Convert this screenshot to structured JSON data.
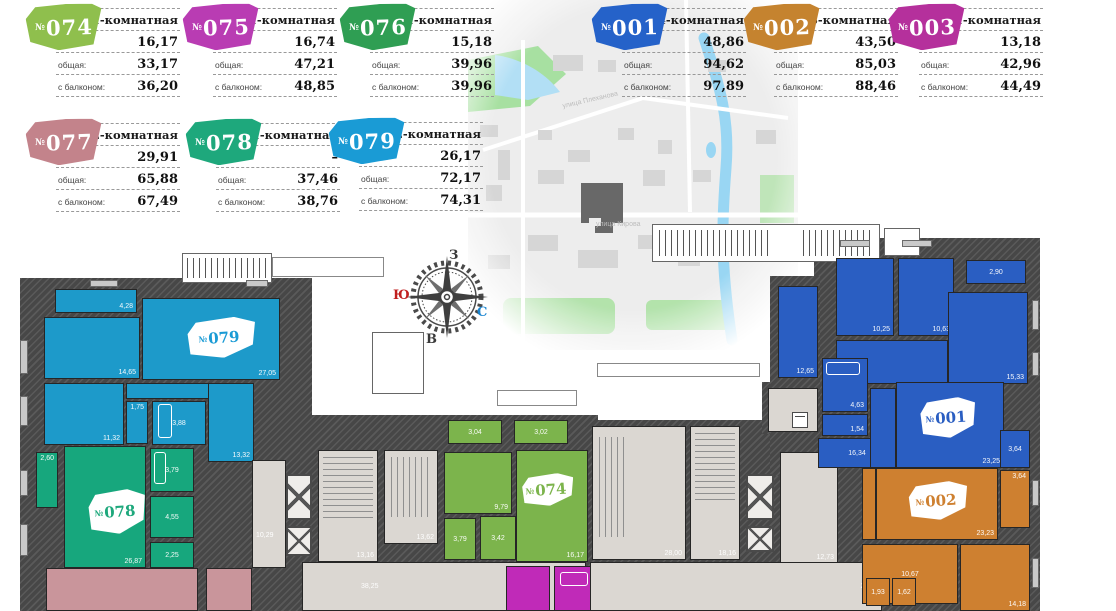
{
  "cards": [
    {
      "prefix": "№",
      "number": "074",
      "color": "#8fbf4d",
      "type": "1-комнатная",
      "rows": [
        {
          "label": "жилая:",
          "value": "16,17"
        },
        {
          "label": "общая:",
          "value": "33,17"
        },
        {
          "label": "с балконом:",
          "value": "36,20"
        }
      ]
    },
    {
      "prefix": "№",
      "number": "075",
      "color": "#b93cb3",
      "type": "1-комнатная",
      "rows": [
        {
          "label": "жилая:",
          "value": "16,74"
        },
        {
          "label": "общая:",
          "value": "47,21"
        },
        {
          "label": "с балконом:",
          "value": "48,85"
        }
      ]
    },
    {
      "prefix": "№",
      "number": "076",
      "color": "#2f9e53",
      "type": "1-комнатная",
      "rows": [
        {
          "label": "жилая:",
          "value": "15,18"
        },
        {
          "label": "общая:",
          "value": "39,96"
        },
        {
          "label": "с балконом:",
          "value": "39,96"
        }
      ]
    },
    {
      "prefix": "№",
      "number": "001",
      "color": "#2562c9",
      "type": "4-комнатная",
      "rows": [
        {
          "label": "жилая:",
          "value": "48,86"
        },
        {
          "label": "общая:",
          "value": "94,62"
        },
        {
          "label": "с балконом:",
          "value": "97,89"
        }
      ]
    },
    {
      "prefix": "№",
      "number": "002",
      "color": "#c5832f",
      "type": "3-комнатная",
      "rows": [
        {
          "label": "жилая:",
          "value": "43,50"
        },
        {
          "label": "общая:",
          "value": "85,03"
        },
        {
          "label": "с балконом:",
          "value": "88,46"
        }
      ]
    },
    {
      "prefix": "№",
      "number": "003",
      "color": "#b5309c",
      "type": "1-комнатная",
      "rows": [
        {
          "label": "жилая:",
          "value": "13,18"
        },
        {
          "label": "общая:",
          "value": "42,96"
        },
        {
          "label": "с балконом:",
          "value": "44,49"
        }
      ]
    },
    {
      "prefix": "№",
      "number": "077",
      "color": "#c3838b",
      "type": "2-комнатная",
      "rows": [
        {
          "label": "жилая:",
          "value": "29,91"
        },
        {
          "label": "общая:",
          "value": "65,88"
        },
        {
          "label": "с балконом:",
          "value": "67,49"
        }
      ]
    },
    {
      "prefix": "№",
      "number": "078",
      "color": "#1ea87c",
      "type": "1-комнатная",
      "rows": [
        {
          "label": "жилая:",
          "value": "–"
        },
        {
          "label": "общая:",
          "value": "37,46"
        },
        {
          "label": "с балконом:",
          "value": "38,76"
        }
      ]
    },
    {
      "prefix": "№",
      "number": "079",
      "color": "#1a9bd5",
      "type": "2-комнатная",
      "rows": [
        {
          "label": "жилая:",
          "value": "26,17"
        },
        {
          "label": "общая:",
          "value": "72,17"
        },
        {
          "label": "с балконом:",
          "value": "74,31"
        }
      ]
    }
  ],
  "compass": {
    "west": "З",
    "south": "Ю",
    "north": "С",
    "east": "В"
  },
  "map": {
    "street1": "улица Плеханова",
    "street2": "улица Кирова"
  },
  "plan": {
    "apt079": {
      "badge": {
        "prefix": "№",
        "num": "079"
      },
      "rooms": {
        "balcony": "4,28",
        "room1": "14,65",
        "living": "27,05",
        "room2": "11,32",
        "wc": "1,75",
        "bath": "3,88",
        "hall": "13,32"
      }
    },
    "apt078": {
      "badge": {
        "prefix": "№",
        "num": "078"
      },
      "rooms": {
        "balcony": "2,60",
        "bath": "3,79",
        "living": "26,87",
        "storage": "4,55",
        "wc": "2,25"
      }
    },
    "apt074": {
      "badge": {
        "prefix": "№",
        "num": "074"
      },
      "rooms": {
        "balcony1": "3,04",
        "balcony2": "3,02",
        "kitchen": "9,79",
        "bath": "3,79",
        "hall": "3,42",
        "living": "16,17"
      }
    },
    "apt001": {
      "badge": {
        "prefix": "№",
        "num": "001"
      },
      "rooms": {
        "room1": "12,65",
        "room2": "10,25",
        "room3": "10,63",
        "balcony1": "2,90",
        "room4": "15,33",
        "bath": "4,63",
        "wc": "1,54",
        "hall": "16,34",
        "living": "23,25",
        "balcony2": "3,64"
      }
    },
    "apt002": {
      "badge": {
        "prefix": "№",
        "num": "002"
      },
      "rooms": {
        "balcony": "3,64",
        "living": "23,23",
        "kitchen": "10,67",
        "wc1": "1,93",
        "wc2": "1,62",
        "room": "14,18"
      }
    },
    "common": {
      "lobby1": "10,29",
      "stairA": "13,16",
      "stairB": "13,62",
      "corridorA": "38,25",
      "stairC": "28,00",
      "stairD": "18,16",
      "corridorB": "12,73",
      "corridorC": "26,44"
    }
  }
}
